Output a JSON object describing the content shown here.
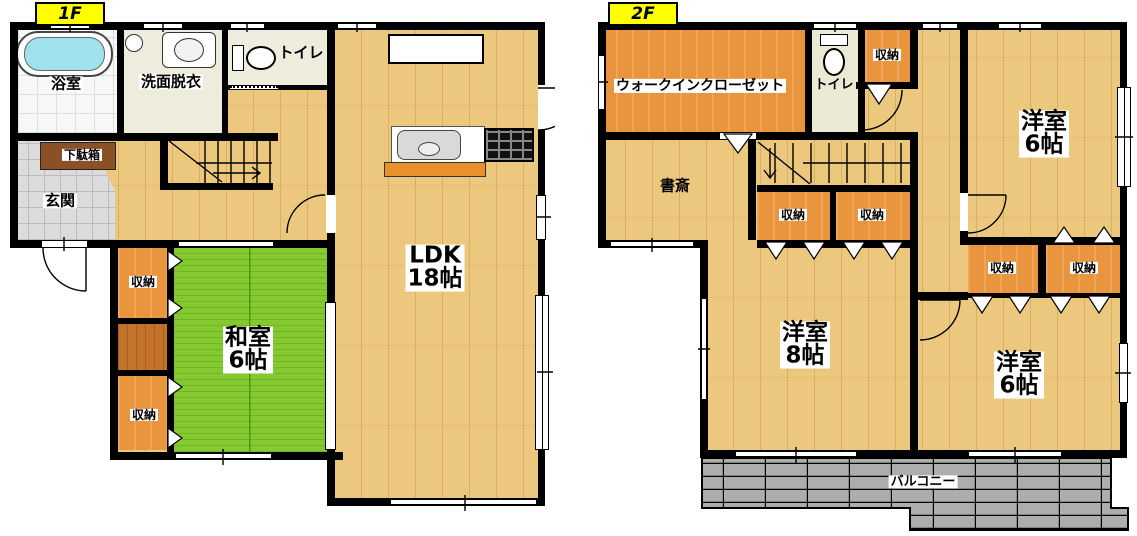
{
  "floor_tags": {
    "f1": "1F",
    "f2": "2F"
  },
  "f1": {
    "bath": "浴室",
    "washroom": "洗面脱衣",
    "toilet": "トイレ",
    "shoe_cabinet": "下駄箱",
    "entrance": "玄関",
    "storage_a": "収納",
    "storage_b": "収納",
    "washitsu": {
      "name": "和室",
      "size": "6帖"
    },
    "ldk": {
      "name": "LDK",
      "size": "18帖"
    }
  },
  "f2": {
    "wic": "ウォークインクローゼット",
    "toilet": "トイレ",
    "storage_top": "収納",
    "bedroom_ne": {
      "name": "洋室",
      "size": "6帖"
    },
    "study": "書斎",
    "storage_hall_a": "収納",
    "storage_hall_b": "収納",
    "bedroom_sw": {
      "name": "洋室",
      "size": "8帖"
    },
    "storage_se_a": "収納",
    "storage_se_b": "収納",
    "bedroom_se": {
      "name": "洋室",
      "size": "6帖"
    },
    "balcony": "バルコニー"
  },
  "colors": {
    "wall": "#000000",
    "wood_floor": "#ECC87E",
    "tatami_green": "#85C930",
    "storage_orange": "#E9953E",
    "closet_brown": "#C4732B",
    "shoe_cabinet_brown": "#8A5126",
    "entrance_tile": "#DCDCDC",
    "wet_area_floor": "#EEECDD",
    "bathtub_cyan": "#9FE2EC",
    "balcony_gray": "#ADADAD",
    "floor_tag_bg": "#FFFF00"
  }
}
